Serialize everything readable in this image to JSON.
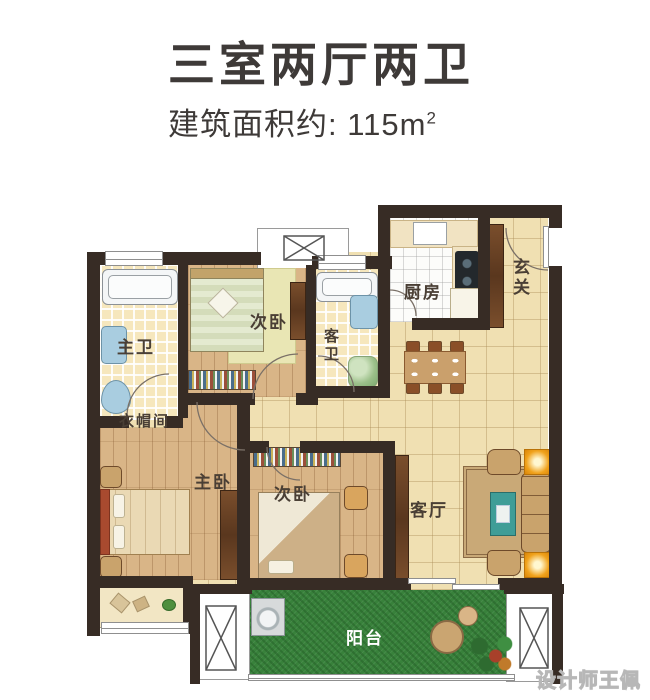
{
  "header": {
    "title": "三室两厅两卫",
    "area_text": "建筑面积约: 115m",
    "area_sup": "2"
  },
  "rooms": {
    "master_bath": "主卫",
    "bedroom_top": "次卧",
    "guest_bath": "客卫",
    "kitchen": "厨房",
    "entry": "玄关",
    "cloakroom": "衣帽间",
    "master_bedroom": "主卧",
    "bedroom_bottom": "次卧",
    "living_room": "客厅",
    "balcony": "阳台"
  },
  "watermark": "设计师王佩",
  "colors": {
    "wall": "#372c25",
    "tile_floor": "#f0e0b2",
    "wood_floor": "#d9b587",
    "bath_tile": "#f6e7bd",
    "grass": "#38813b",
    "accent_orange": "#f0a21c",
    "teal_table": "#3f9d97",
    "label_text": "#4a3f35"
  }
}
